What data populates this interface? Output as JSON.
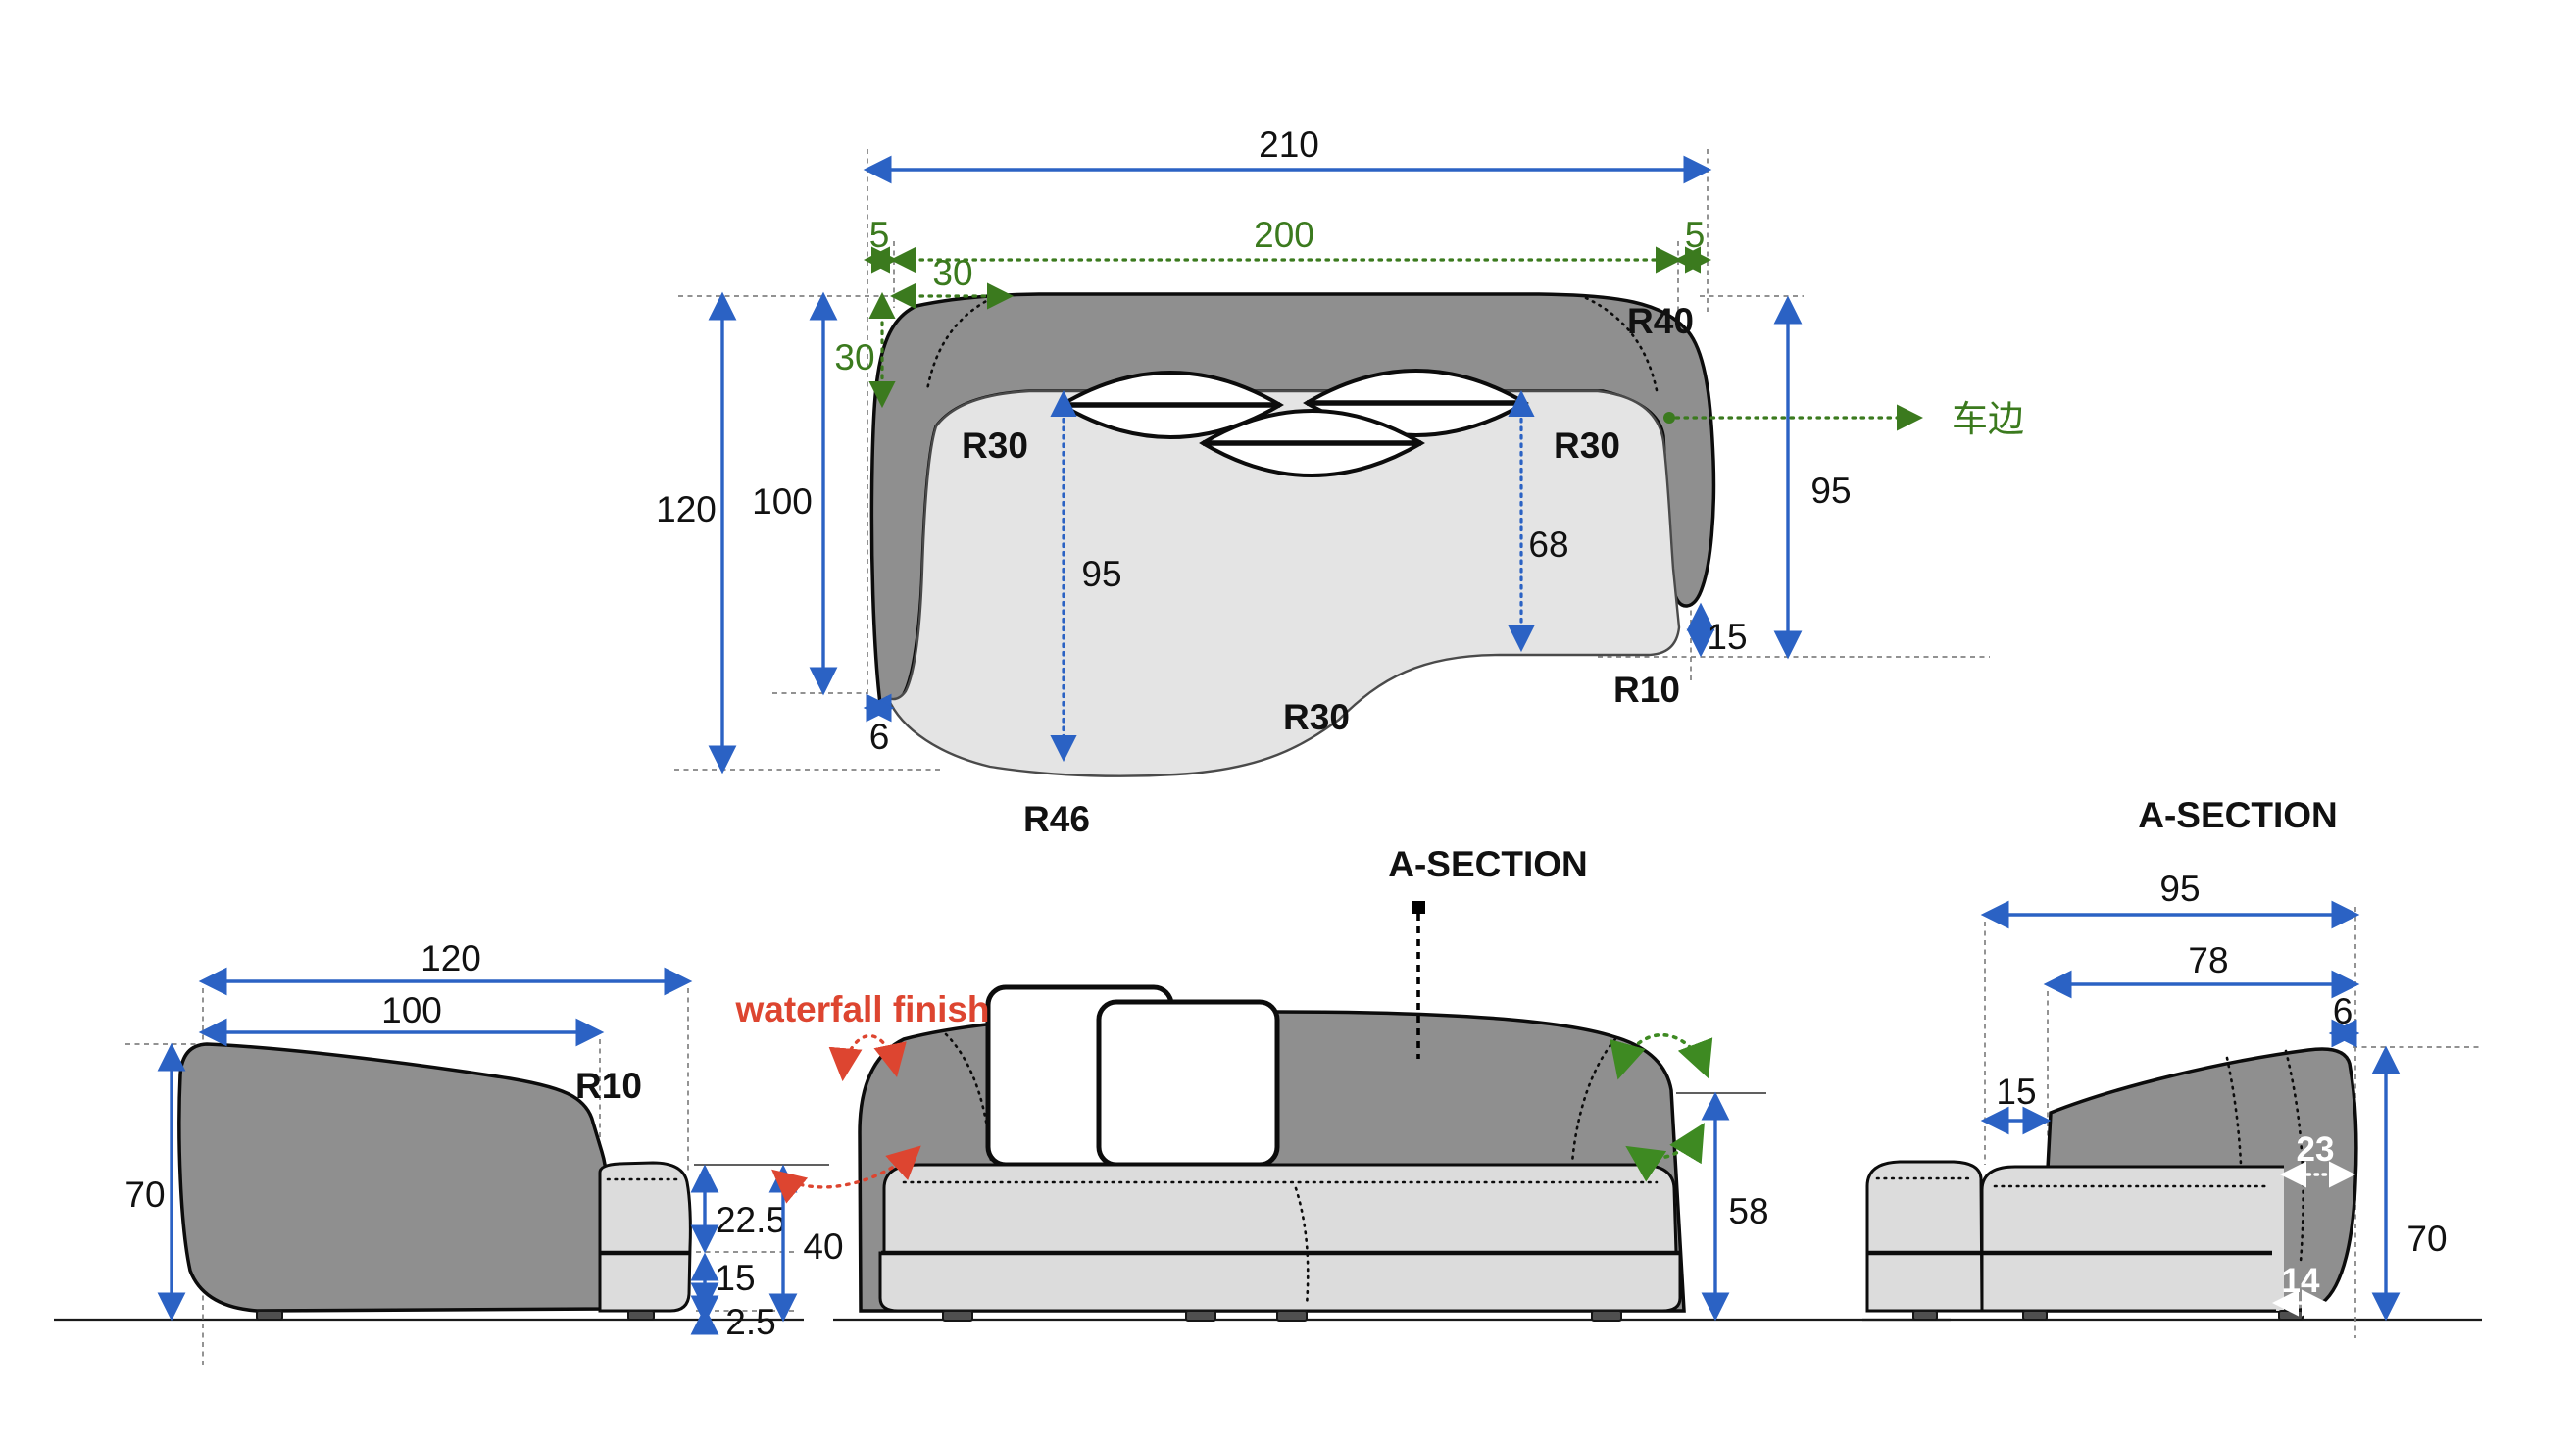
{
  "colors": {
    "dimension_blue": "#2b62c4",
    "dimension_green": "#3b7a1e",
    "annotation_red": "#dd4530",
    "fabric_dark": "#8f8f8f",
    "fabric_light": "#e4e4e4",
    "cushion_light": "#dcdcdc"
  },
  "top_view": {
    "dim_total_width": "210",
    "dim_gap_left": "5",
    "dim_inner_width": "200",
    "dim_gap_right": "5",
    "dim_corner_offset_h": "30",
    "dim_corner_offset_v": "30",
    "radius_top_right": "R40",
    "stitch_note": "车边",
    "radius_inner_left": "R30",
    "radius_inner_right": "R30",
    "dim_total_depth": "120",
    "dim_arm_depth": "100",
    "dim_seat_depth_left": "95",
    "dim_seat_depth_right": "68",
    "dim_right_height": "95",
    "dim_arm_gap": "15",
    "radius_seat_corner": "R10",
    "radius_seat_bottom": "R30",
    "dim_arm_tip": "6",
    "radius_chaise": "R46"
  },
  "side_view": {
    "dim_total_depth": "120",
    "dim_top_depth": "100",
    "radius_front_top": "R10",
    "dim_back_height": "70",
    "dim_cushion": "22.5",
    "dim_seat_total": "40",
    "dim_base": "15",
    "dim_leg": "2.5"
  },
  "front_view": {
    "note_finish": "waterfall finish",
    "section_label": "A-SECTION",
    "dim_arm_height": "58"
  },
  "section_view": {
    "title": "A-SECTION",
    "dim_total_depth": "95",
    "dim_seat_depth": "78",
    "dim_back_top": "6",
    "dim_gap_front": "15",
    "dim_back_upper": "23",
    "dim_height": "70",
    "dim_back_lower": "14"
  }
}
